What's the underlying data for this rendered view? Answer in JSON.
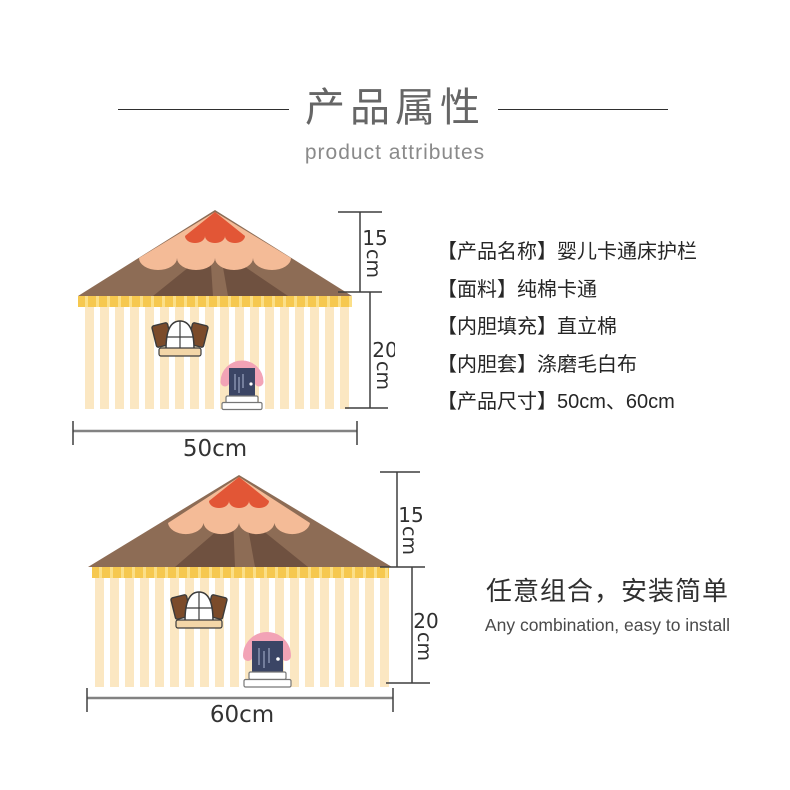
{
  "header": {
    "title": "产品属性",
    "subtitle": "product attributes"
  },
  "attributes": {
    "items": [
      "【产品名称】婴儿卡通床护栏",
      "【面料】纯棉卡通",
      "【内胆填充】直立棉",
      "【内胆套】涤磨毛白布",
      "【产品尺寸】50cm、60cm"
    ]
  },
  "diagrams": {
    "small_house": {
      "roof_height": "15",
      "roof_unit": "cm",
      "wall_height": "20",
      "wall_unit": "cm",
      "width_label": "50cm"
    },
    "large_house": {
      "roof_height": "15",
      "roof_unit": "cm",
      "wall_height": "20",
      "wall_unit": "cm",
      "width_label": "60cm"
    }
  },
  "footer": {
    "headline": "任意组合，安装简单",
    "subheadline": "Any combination, easy to install"
  },
  "colors": {
    "roof_red": "#e25636",
    "roof_peach": "#f4bb97",
    "roof_brown": "#8d6c55",
    "roof_brown_dark": "#6f5140",
    "eave_yellow": "#f6c84f",
    "eave_yellow_light": "#fbdf88",
    "wall_cream": "#fbe7c2",
    "door_navy": "#3b4565",
    "awning_pink": "#f2a3b6",
    "shutter_brown": "#7b4b2a",
    "sill_tan": "#f3d6a8",
    "dimension_line": "#3f3f3f"
  }
}
